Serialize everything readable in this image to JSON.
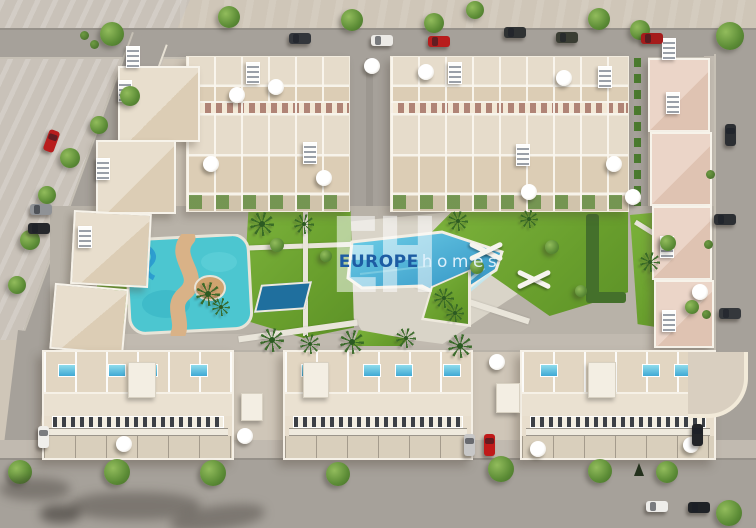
{
  "watermark": {
    "monogram": "EH",
    "brand_bold": "EUROPE",
    "brand_light": "homes",
    "brand_bold_color": "#1d5ca3",
    "brand_light_color": "#e2f1fc"
  },
  "colors": {
    "sand": "#cfc6b8",
    "rough_terrain": "#c9c2b9",
    "road": "#a6a19a",
    "sidewalk": "#c1bab0",
    "park_paving": "#b8b2a8",
    "pool_deck": "#d9d4c8",
    "grass": "#6fa431",
    "hedge": "#44702b",
    "roof_cream": "#e6dccb",
    "terrace_tan": "#dccdb5",
    "balcony_strip": "#b08476",
    "roof_pink": "#ebd5c8",
    "parapet_white": "#f7f3ea",
    "main_pool_blue": "#3fa9d4",
    "kids_pool_blue": "#1f6f9e",
    "splash_pool_teal": "#4cc6d0",
    "splash_path_sand": "#d9b287",
    "car_red": "#b81d1d",
    "car_white": "#eceae6",
    "car_silver": "#c7c7c7",
    "car_dark": "#2c2f33"
  }
}
